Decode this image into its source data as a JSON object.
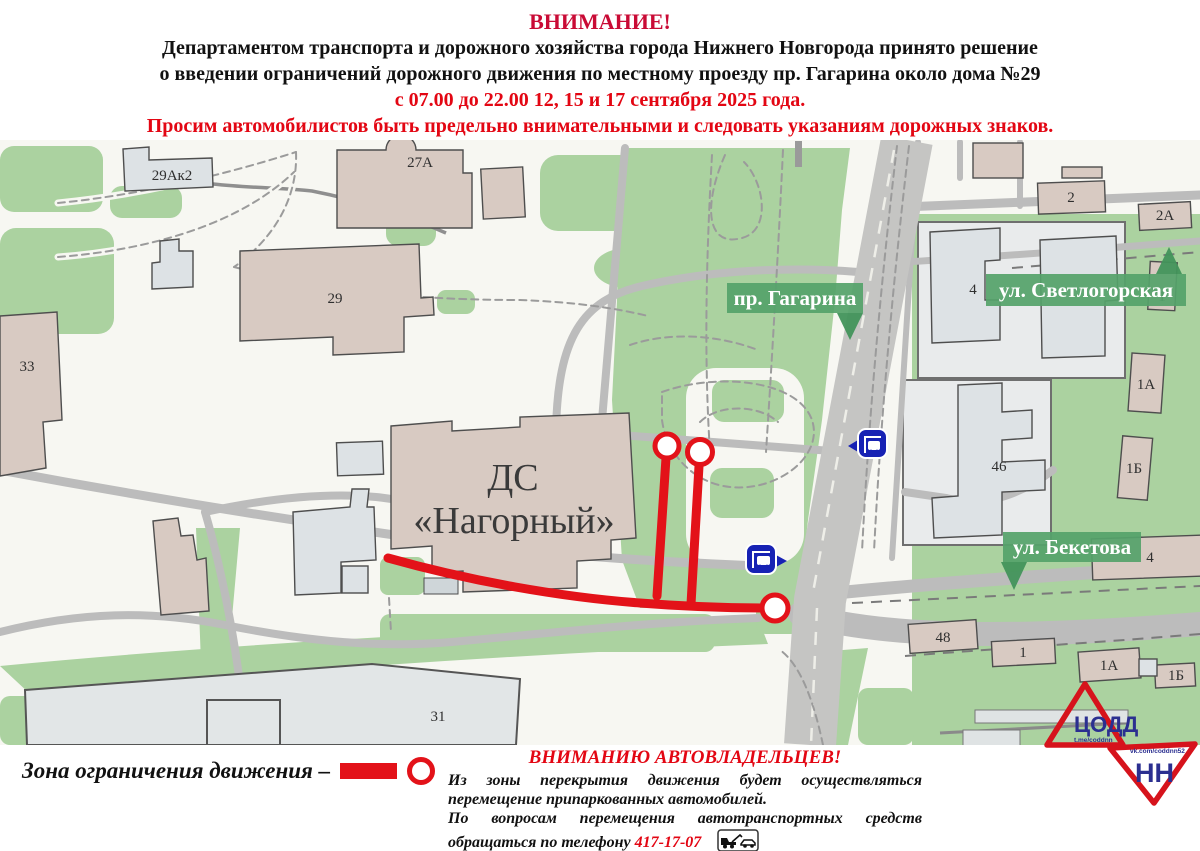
{
  "header": {
    "attention": "ВНИМАНИЕ!",
    "line1": "Департаментом транспорта и дорожного хозяйства города Нижнего Новгорода принято решение",
    "line2": "о введении ограничений дорожного движения по местному проезду пр. Гагарина около дома №29",
    "line3": "с 07.00 до 22.00 12, 15 и 17 сентября 2025 года.",
    "line4": "Просим автомобилистов быть предельно внимательными и следовать указаниям дорожных знаков."
  },
  "map": {
    "street_labels": {
      "gagarina": "пр. Гагарина",
      "svetlogorskaya": "ул. Светлогорская",
      "beketova": "ул. Бекетова"
    },
    "venue_line1": "ДС",
    "venue_line2": "«Нагорный»",
    "buildings": {
      "b29ak2": "29Ак2",
      "b27a": "27А",
      "b29": "29",
      "b33": "33",
      "b31": "31",
      "b2": "2",
      "b2a": "2А",
      "b4_yard": "4",
      "b46": "46",
      "b1_svetl": "1",
      "b1a_svetl": "1А",
      "b1b_svetl": "1Б",
      "b4_beketova": "4",
      "b48": "48",
      "b1_beketova": "1",
      "b1a_beketova": "1А",
      "b1b_beketova": "1Б"
    }
  },
  "legend": {
    "zone_label": "Зона ограничения движения –"
  },
  "notice": {
    "heading": "ВНИМАНИЮ АВТОВЛАДЕЛЬЦЕВ!",
    "para1": "Из зоны перекрытия движения будет осуществляться перемещение припаркованных автомобилей.",
    "para2_prefix": "По вопросам перемещения автотранспортных средств обращаться по телефону ",
    "phone": "417-17-07"
  },
  "logo": {
    "title": "ЦОДД",
    "region": "НН",
    "telegram": "t.me/coddnn",
    "vk": "vk.com/coddnn52"
  },
  "colors": {
    "restriction_red": "#e31219",
    "header_red": "#e30613",
    "attention_crimson": "#c90a35",
    "banner_green": "#55a36a",
    "map_green": "#abd2a0",
    "bus_icon_blue": "#1722b4",
    "logo_red": "#d6131c",
    "logo_blue": "#2b2f90"
  }
}
